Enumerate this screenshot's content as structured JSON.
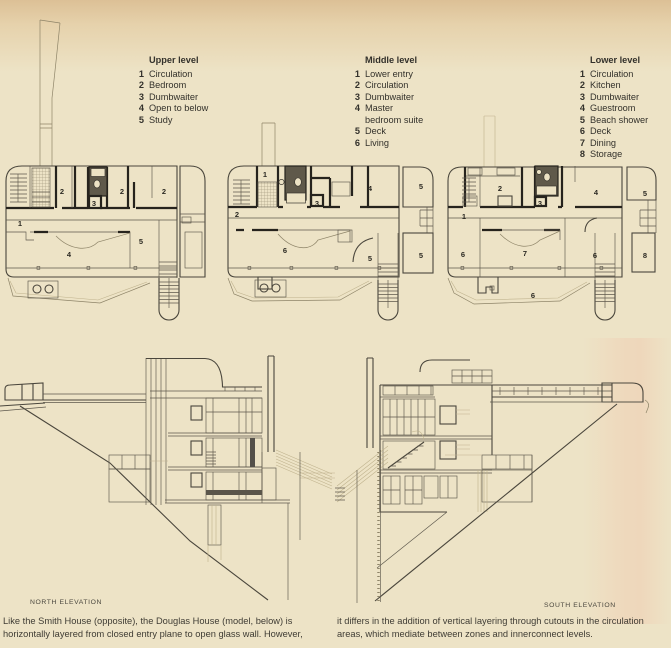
{
  "colors": {
    "paper": "#ede3c6",
    "ink": "#4a463c",
    "wall": "#26231d",
    "scan_pink": "#f2b098",
    "top_tan": "#dcc096"
  },
  "plans": [
    {
      "id": "upper",
      "title": "Upper level",
      "legend": [
        {
          "num": "1",
          "label": "Circulation"
        },
        {
          "num": "2",
          "label": "Bedroom"
        },
        {
          "num": "3",
          "label": "Dumbwaiter"
        },
        {
          "num": "4",
          "label": "Open to below"
        },
        {
          "num": "5",
          "label": "Study"
        }
      ],
      "room_labels": [
        "2",
        "2",
        "2",
        "3",
        "1",
        "4",
        "5"
      ]
    },
    {
      "id": "middle",
      "title": "Middle level",
      "legend": [
        {
          "num": "1",
          "label": "Lower entry"
        },
        {
          "num": "2",
          "label": "Circulation"
        },
        {
          "num": "3",
          "label": "Dumbwaiter"
        },
        {
          "num": "4",
          "label": "Master bedroom suite"
        },
        {
          "num": "5",
          "label": "Deck"
        },
        {
          "num": "6",
          "label": "Living"
        }
      ],
      "room_labels": [
        "1",
        "2",
        "3",
        "4",
        "5",
        "6",
        "5",
        "5"
      ]
    },
    {
      "id": "lower",
      "title": "Lower level",
      "legend": [
        {
          "num": "1",
          "label": "Circulation"
        },
        {
          "num": "2",
          "label": "Kitchen"
        },
        {
          "num": "3",
          "label": "Dumbwaiter"
        },
        {
          "num": "4",
          "label": "Guestroom"
        },
        {
          "num": "5",
          "label": "Beach shower"
        },
        {
          "num": "6",
          "label": "Deck"
        },
        {
          "num": "7",
          "label": "Dining"
        },
        {
          "num": "8",
          "label": "Storage"
        }
      ],
      "room_labels": [
        "2",
        "3",
        "4",
        "5",
        "1",
        "6",
        "7",
        "6",
        "8",
        "6"
      ]
    }
  ],
  "elevations": [
    {
      "caption": "NORTH ELEVATION"
    },
    {
      "caption": "SOUTH ELEVATION"
    }
  ],
  "captions": {
    "left": "Like the Smith House (opposite), the Douglas House (model, below) is horizontally layered from closed entry plane to open glass wall. However,",
    "right": "it differs in the addition of vertical layering through cutouts in the circulation areas, which mediate between zones and innerconnect levels."
  }
}
